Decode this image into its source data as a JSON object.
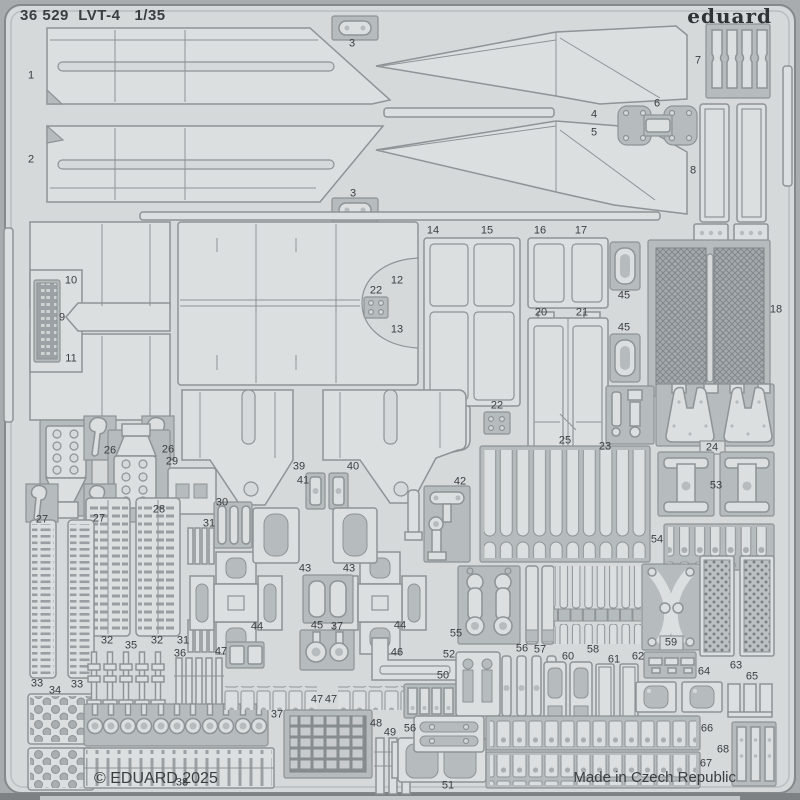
{
  "header": {
    "catalog_number": "36 529",
    "product_name": "LVT-4",
    "scale": "1/35",
    "combined": "36 529  LVT-4   1/35"
  },
  "brand": {
    "logo_text": "eduard"
  },
  "footer": {
    "copyright": "© EDUARD 2025",
    "made_in": "Made in Czech Republic"
  },
  "colors": {
    "bg": "#a8acaf",
    "sheet": "#d6d9da",
    "part": "#dcdfe0",
    "half": "#b6bbbd",
    "line": "#8d9396",
    "text": "#3a3e41",
    "dark_band": "#7d8184"
  },
  "parts": {
    "labels": [
      {
        "n": "1",
        "x": 31,
        "y": 76
      },
      {
        "n": "2",
        "x": 31,
        "y": 160
      },
      {
        "n": "3",
        "x": 352,
        "y": 44
      },
      {
        "n": "3",
        "x": 353,
        "y": 194
      },
      {
        "n": "4",
        "x": 594,
        "y": 115
      },
      {
        "n": "5",
        "x": 594,
        "y": 133
      },
      {
        "n": "6",
        "x": 657,
        "y": 104
      },
      {
        "n": "7",
        "x": 698,
        "y": 61
      },
      {
        "n": "8",
        "x": 693,
        "y": 171
      },
      {
        "n": "9",
        "x": 62,
        "y": 318
      },
      {
        "n": "10",
        "x": 71,
        "y": 281
      },
      {
        "n": "11",
        "x": 71,
        "y": 359
      },
      {
        "n": "12",
        "x": 397,
        "y": 281
      },
      {
        "n": "13",
        "x": 397,
        "y": 330
      },
      {
        "n": "14",
        "x": 433,
        "y": 231
      },
      {
        "n": "15",
        "x": 487,
        "y": 231
      },
      {
        "n": "16",
        "x": 540,
        "y": 231
      },
      {
        "n": "17",
        "x": 581,
        "y": 231
      },
      {
        "n": "18",
        "x": 776,
        "y": 310
      },
      {
        "n": "20",
        "x": 541,
        "y": 313
      },
      {
        "n": "21",
        "x": 582,
        "y": 313
      },
      {
        "n": "22",
        "x": 376,
        "y": 291
      },
      {
        "n": "22",
        "x": 497,
        "y": 406
      },
      {
        "n": "23",
        "x": 605,
        "y": 447
      },
      {
        "n": "24",
        "x": 712,
        "y": 448
      },
      {
        "n": "25",
        "x": 565,
        "y": 441
      },
      {
        "n": "26",
        "x": 110,
        "y": 451
      },
      {
        "n": "26",
        "x": 168,
        "y": 450
      },
      {
        "n": "27",
        "x": 42,
        "y": 520
      },
      {
        "n": "27",
        "x": 99,
        "y": 519
      },
      {
        "n": "28",
        "x": 159,
        "y": 510
      },
      {
        "n": "29",
        "x": 172,
        "y": 462
      },
      {
        "n": "30",
        "x": 222,
        "y": 503
      },
      {
        "n": "31",
        "x": 209,
        "y": 524
      },
      {
        "n": "31",
        "x": 183,
        "y": 641
      },
      {
        "n": "32",
        "x": 107,
        "y": 641
      },
      {
        "n": "32",
        "x": 157,
        "y": 641
      },
      {
        "n": "33",
        "x": 37,
        "y": 684
      },
      {
        "n": "33",
        "x": 77,
        "y": 685
      },
      {
        "n": "34",
        "x": 55,
        "y": 691
      },
      {
        "n": "35",
        "x": 131,
        "y": 646
      },
      {
        "n": "36",
        "x": 180,
        "y": 654
      },
      {
        "n": "37",
        "x": 337,
        "y": 627
      },
      {
        "n": "37",
        "x": 277,
        "y": 715
      },
      {
        "n": "38",
        "x": 182,
        "y": 783
      },
      {
        "n": "39",
        "x": 299,
        "y": 467
      },
      {
        "n": "40",
        "x": 353,
        "y": 467
      },
      {
        "n": "41",
        "x": 303,
        "y": 481
      },
      {
        "n": "42",
        "x": 460,
        "y": 482
      },
      {
        "n": "43",
        "x": 305,
        "y": 569
      },
      {
        "n": "43",
        "x": 349,
        "y": 569
      },
      {
        "n": "44",
        "x": 257,
        "y": 627
      },
      {
        "n": "44",
        "x": 400,
        "y": 626
      },
      {
        "n": "45",
        "x": 624,
        "y": 296
      },
      {
        "n": "45",
        "x": 624,
        "y": 328
      },
      {
        "n": "45",
        "x": 317,
        "y": 626
      },
      {
        "n": "46",
        "x": 397,
        "y": 653
      },
      {
        "n": "47",
        "x": 221,
        "y": 652
      },
      {
        "n": "47",
        "x": 317,
        "y": 700
      },
      {
        "n": "47",
        "x": 331,
        "y": 700
      },
      {
        "n": "48",
        "x": 376,
        "y": 724
      },
      {
        "n": "49",
        "x": 390,
        "y": 733
      },
      {
        "n": "50",
        "x": 443,
        "y": 676
      },
      {
        "n": "51",
        "x": 448,
        "y": 786
      },
      {
        "n": "52",
        "x": 449,
        "y": 655
      },
      {
        "n": "53",
        "x": 716,
        "y": 486
      },
      {
        "n": "54",
        "x": 657,
        "y": 540
      },
      {
        "n": "55",
        "x": 456,
        "y": 634
      },
      {
        "n": "56",
        "x": 522,
        "y": 649
      },
      {
        "n": "56",
        "x": 410,
        "y": 729
      },
      {
        "n": "57",
        "x": 540,
        "y": 650
      },
      {
        "n": "58",
        "x": 593,
        "y": 650
      },
      {
        "n": "59",
        "x": 671,
        "y": 643
      },
      {
        "n": "60",
        "x": 568,
        "y": 657
      },
      {
        "n": "61",
        "x": 614,
        "y": 660
      },
      {
        "n": "62",
        "x": 638,
        "y": 657
      },
      {
        "n": "63",
        "x": 736,
        "y": 666
      },
      {
        "n": "64",
        "x": 704,
        "y": 672
      },
      {
        "n": "65",
        "x": 752,
        "y": 677
      },
      {
        "n": "66",
        "x": 707,
        "y": 729
      },
      {
        "n": "67",
        "x": 706,
        "y": 764
      },
      {
        "n": "68",
        "x": 723,
        "y": 750
      }
    ]
  }
}
